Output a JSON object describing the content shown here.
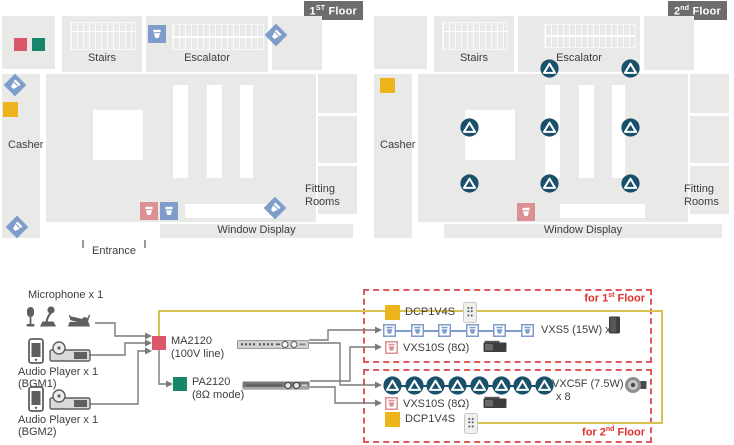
{
  "colors": {
    "floor_gray": "#e9e9e7",
    "badge_gray": "#6d6d6d",
    "ma_red": "#d9566b",
    "pa_green": "#17866b",
    "dcp_yellow": "#eeb41c",
    "vxs5_blue": "#7f9dca",
    "vxs10s_pink": "#dd9093",
    "vxc5f_teal": "#1a516a",
    "zone_dash_red": "#e25757",
    "zone_text_red": "#e0302c",
    "wire_yellow": "#d8c14e",
    "wire_gray": "#7a7a7a"
  },
  "floors": [
    {
      "badge": {
        "num": "1",
        "sup": "ST",
        "word": " Floor"
      },
      "labels": {
        "stairs": "Stairs",
        "escalator": "Escalator",
        "casher": "Casher",
        "fitting1": "Fitting",
        "fitting2": "Rooms",
        "window": "Window Display",
        "entrance": "Entrance"
      },
      "devices": [
        {
          "type": "ma-marker",
          "name": "ma2120-location-icon",
          "x": 14,
          "y": 38
        },
        {
          "type": "pa-marker",
          "name": "pa2120-location-icon",
          "x": 32,
          "y": 38
        },
        {
          "type": "dcp-marker",
          "name": "dcp1v4s-location-icon",
          "x": 3,
          "y": 102
        },
        {
          "type": "vxs5-diamond",
          "name": "vxs5-speaker-icon",
          "x": 7,
          "y": 77
        },
        {
          "type": "vxs5-diamond",
          "name": "vxs5-speaker-icon",
          "x": 268,
          "y": 27
        },
        {
          "type": "vxs5-diamond",
          "name": "vxs5-speaker-icon",
          "x": 267,
          "y": 200
        },
        {
          "type": "vxs5-diamond",
          "name": "vxs5-speaker-icon",
          "x": 9,
          "y": 219
        },
        {
          "type": "vxs5-wall",
          "name": "vxs5-speaker-icon",
          "x": 148,
          "y": 25
        },
        {
          "type": "vxs10s-wall",
          "name": "vxs10s-subwoofer-icon",
          "x": 140,
          "y": 202
        },
        {
          "type": "vxs5-wall",
          "name": "vxs5-speaker-icon",
          "x": 160,
          "y": 202
        }
      ]
    },
    {
      "badge": {
        "num": "2",
        "sup": "nd",
        "word": " Floor"
      },
      "labels": {
        "stairs": "Stairs",
        "escalator": "Escalator",
        "casher": "Casher",
        "fitting1": "Fitting",
        "fitting2": "Rooms",
        "window": "Window Display"
      },
      "devices": [
        {
          "type": "dcp-marker",
          "name": "dcp1v4s-location-icon",
          "x": 380,
          "y": 78
        },
        {
          "type": "vxc5f-ceiling",
          "name": "vxc5f-ceiling-speaker-icon",
          "x": 540,
          "y": 59
        },
        {
          "type": "vxc5f-ceiling",
          "name": "vxc5f-ceiling-speaker-icon",
          "x": 621,
          "y": 59
        },
        {
          "type": "vxc5f-ceiling",
          "name": "vxc5f-ceiling-speaker-icon",
          "x": 460,
          "y": 118
        },
        {
          "type": "vxc5f-ceiling",
          "name": "vxc5f-ceiling-speaker-icon",
          "x": 540,
          "y": 118
        },
        {
          "type": "vxc5f-ceiling",
          "name": "vxc5f-ceiling-speaker-icon",
          "x": 621,
          "y": 118
        },
        {
          "type": "vxc5f-ceiling",
          "name": "vxc5f-ceiling-speaker-icon",
          "x": 460,
          "y": 174
        },
        {
          "type": "vxc5f-ceiling",
          "name": "vxc5f-ceiling-speaker-icon",
          "x": 540,
          "y": 174
        },
        {
          "type": "vxc5f-ceiling",
          "name": "vxc5f-ceiling-speaker-icon",
          "x": 621,
          "y": 174
        },
        {
          "type": "vxs10s-wall",
          "name": "vxs10s-subwoofer-icon",
          "x": 517,
          "y": 203
        }
      ]
    }
  ],
  "system": {
    "mic_label": "Microphone x 1",
    "player1_label": "Audio Player x 1",
    "player1_sub": "(BGM1)",
    "player2_label": "Audio Player x 1",
    "player2_sub": "(BGM2)",
    "ma_name": "MA2120",
    "ma_mode": "(100V line)",
    "pa_name": "PA2120",
    "pa_mode": "(8Ω mode)"
  },
  "zones": [
    {
      "title_pre": "for 1",
      "title_sup": "st",
      "title_post": " Floor",
      "dcp_label": "DCP1V4S",
      "chain": {
        "type": "vxs5",
        "count": 6,
        "label": "VXS5 (15W) x 6"
      },
      "sub_label": "VXS10S (8Ω)"
    },
    {
      "title_pre": "for 2",
      "title_sup": "nd",
      "title_post": " Floor",
      "dcp_label": "DCP1V4S",
      "chain": {
        "type": "vxc5f",
        "count": 8,
        "label": "VXC5F (7.5W)",
        "count_label": "x 8"
      },
      "sub_label": "VXS10S (8Ω)"
    }
  ]
}
